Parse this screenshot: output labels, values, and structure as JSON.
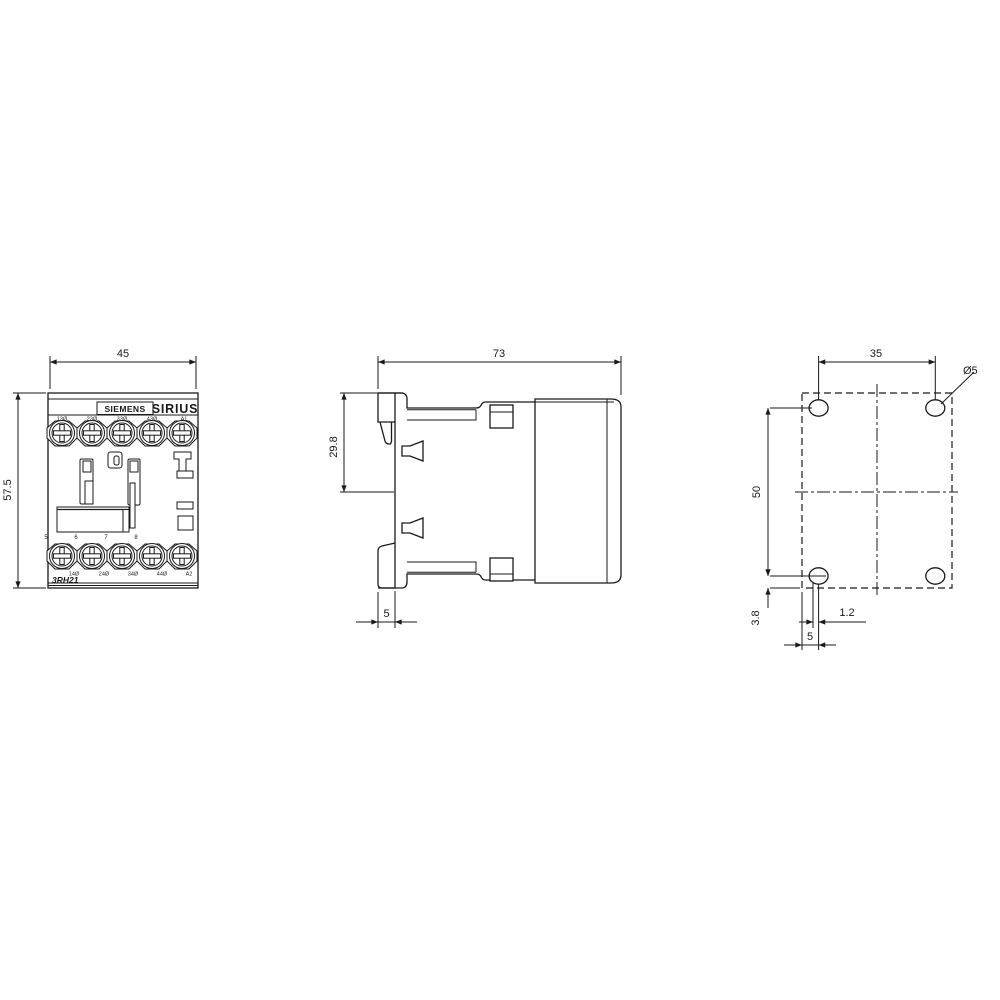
{
  "drawing": {
    "front": {
      "width_dim": "45",
      "height_dim": "57.5",
      "brand": "SIEMENS",
      "series": "SIRIUS",
      "model": "3RH21",
      "top_terminals": [
        "13Ø",
        "23Ø",
        "33Ø",
        "43Ø",
        "A1"
      ],
      "bottom_terminals": [
        "14Ø",
        "24Ø",
        "34Ø",
        "44Ø",
        "A2"
      ],
      "terminal_numbers": [
        "5",
        "6",
        "7",
        "8"
      ]
    },
    "side": {
      "depth_dim": "73",
      "top_to_rail_dim": "29.8",
      "clip_depth_dim": "5"
    },
    "drill": {
      "hole_spacing_h_dim": "35",
      "hole_spacing_v_dim": "50",
      "bottom_offset_dim": "3.8",
      "slot_offset_dim": "1.2",
      "edge_offset_dim": "5",
      "hole_diameter": "Ø5"
    }
  },
  "colors": {
    "line": "#1a1a1a",
    "background": "#ffffff"
  }
}
